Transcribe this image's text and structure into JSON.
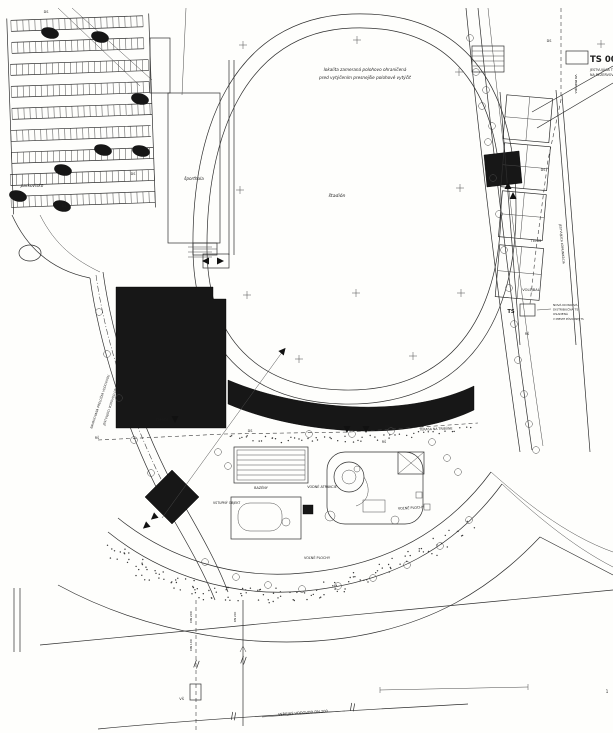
{
  "drawing": {
    "type": "site-plan",
    "language": "sk",
    "paper_color": "#fefefc",
    "ink_color": "#1c1c1c",
    "building_fill": "#171717"
  },
  "legend": {
    "ts_title": "TS 0062-",
    "ts_note1": "JESTVUJÚCA TS, NA",
    "ts_note2": "NA REZERVOVÝ VÝVOD"
  },
  "labels": [
    {
      "name": "survey-note-line1",
      "text": "lokalita zameraná polohovo ohraničená",
      "x": 365,
      "y": 71,
      "s": 4.2,
      "i": 1,
      "a": "middle"
    },
    {
      "name": "survey-note-line2",
      "text": "pred vytýčením presnejšie polohové vytýčiť",
      "x": 365,
      "y": 79,
      "s": 4.2,
      "i": 1,
      "a": "middle"
    },
    {
      "name": "stadium-label",
      "text": "štadión",
      "x": 337,
      "y": 197,
      "s": 4.6,
      "i": 1,
      "a": "middle"
    },
    {
      "name": "sporthall-label",
      "text": "športhala",
      "x": 194,
      "y": 180,
      "s": 4.2,
      "i": 1,
      "a": "middle"
    },
    {
      "name": "parking-label",
      "text": "parkovisko",
      "x": 32,
      "y": 187,
      "s": 4.2,
      "i": 1,
      "a": "middle"
    },
    {
      "name": "legend-ts-title",
      "text": "TS 0062-",
      "x": 590,
      "y": 62,
      "s": 8.5,
      "a": "start",
      "b": 1
    },
    {
      "name": "legend-ts-note1",
      "text": "JESTVUJÚCA TS, NA",
      "x": 590,
      "y": 71,
      "s": 3.3,
      "a": "start"
    },
    {
      "name": "legend-ts-note2",
      "text": "NA REZERVOVÝ VÝVOD",
      "x": 590,
      "y": 76,
      "s": 3.3,
      "a": "start"
    },
    {
      "name": "vn-line-label",
      "text": "VN PRÍPOJKA",
      "x": 575,
      "y": 84,
      "s": 3,
      "r": 90,
      "a": "middle"
    },
    {
      "name": "tennis-label",
      "text": "TENIS",
      "x": 536,
      "y": 242,
      "s": 3.6,
      "a": "middle"
    },
    {
      "name": "volleyball-label",
      "text": "VOLEJBAL",
      "x": 531,
      "y": 291,
      "s": 3.6,
      "a": "middle"
    },
    {
      "name": "ts-mid-label",
      "text": "TS",
      "x": 511,
      "y": 313,
      "s": 5.2,
      "a": "middle",
      "b": 1
    },
    {
      "name": "ts-mid-note1",
      "text": "NOVÁ KIOSKOVÁ",
      "x": 553,
      "y": 306,
      "s": 3,
      "a": "start"
    },
    {
      "name": "ts-mid-note2",
      "text": "DISTRIBUČNÁ TS",
      "x": 553,
      "y": 310.5,
      "s": 3,
      "a": "start"
    },
    {
      "name": "ts-mid-note3",
      "text": "OSADENÁ",
      "x": 553,
      "y": 315,
      "s": 3,
      "a": "start"
    },
    {
      "name": "ts-mid-note4",
      "text": "V MIESTE PÔVODNEJ TS",
      "x": 553,
      "y": 320,
      "s": 2.6,
      "a": "start"
    },
    {
      "name": "terrace-label",
      "text": "TERASA NA TRIBÚNE",
      "x": 436,
      "y": 430,
      "s": 3.2,
      "r": -2,
      "a": "middle"
    },
    {
      "name": "terrace2-label",
      "text": "TERASA",
      "x": 162,
      "y": 421,
      "s": 3.2,
      "a": "middle"
    },
    {
      "name": "pools-label",
      "text": "BAZÉNY",
      "x": 261,
      "y": 489,
      "s": 3.4,
      "a": "middle"
    },
    {
      "name": "water-attractions-label",
      "text": "VODNÉ ATRAKCIE",
      "x": 322,
      "y": 488,
      "s": 3.4,
      "a": "middle"
    },
    {
      "name": "open-areas-label-1",
      "text": "VOĽNÉ PLOCHY",
      "x": 411,
      "y": 509,
      "s": 3.4,
      "r": -3,
      "a": "middle"
    },
    {
      "name": "open-areas-label-2",
      "text": "VOĽNÉ PLOCHY",
      "x": 317,
      "y": 559,
      "s": 3.4,
      "a": "middle"
    },
    {
      "name": "entrance-object-label",
      "text": "VSTUPNÝ OBJEKT",
      "x": 213,
      "y": 504,
      "s": 3.2,
      "a": "start"
    },
    {
      "name": "public-watermain-label",
      "text": "VEREJNÝ VODOVOD DN 200",
      "x": 303,
      "y": 714,
      "s": 3.6,
      "r": -4,
      "a": "middle"
    },
    {
      "name": "dn100-label",
      "text": "DN 100",
      "x": 192,
      "y": 645,
      "s": 3,
      "r": -90,
      "a": "middle"
    },
    {
      "name": "dn200-label",
      "text": "DN 200",
      "x": 192,
      "y": 617,
      "s": 3,
      "r": -90,
      "a": "middle"
    },
    {
      "name": "dn200b-label",
      "text": "DN 200",
      "x": 236,
      "y": 617,
      "s": 2.8,
      "r": -90,
      "a": "middle"
    },
    {
      "name": "vs-shaft-label",
      "text": "VŠ",
      "x": 184,
      "y": 700,
      "s": 3.6,
      "a": "end"
    },
    {
      "name": "ds-label-1",
      "text": "DS",
      "x": 46,
      "y": 13,
      "s": 3.4,
      "a": "middle"
    },
    {
      "name": "ds-label-2",
      "text": "DS",
      "x": 64,
      "y": 207,
      "s": 3.4,
      "a": "middle"
    },
    {
      "name": "ds-label-3",
      "text": "DS",
      "x": 133,
      "y": 175,
      "s": 3.4,
      "a": "middle"
    },
    {
      "name": "ds-label-4",
      "text": "DS",
      "x": 250,
      "y": 432,
      "s": 3.4,
      "a": "middle"
    },
    {
      "name": "ds-label-5",
      "text": "DS",
      "x": 387,
      "y": 428,
      "s": 3.4,
      "a": "middle"
    },
    {
      "name": "ds-label-6",
      "text": "DS",
      "x": 549,
      "y": 42,
      "s": 3.4,
      "a": "middle"
    },
    {
      "name": "ds-label-7",
      "text": "DS",
      "x": 543,
      "y": 171,
      "s": 3.4,
      "a": "middle"
    },
    {
      "name": "rs-label-1",
      "text": "RŠ",
      "x": 384,
      "y": 443,
      "s": 3.2,
      "a": "middle"
    },
    {
      "name": "rs-label-2",
      "text": "RŠ",
      "x": 97,
      "y": 439,
      "s": 3.2,
      "a": "middle"
    },
    {
      "name": "rs-label-3",
      "text": "RŠ",
      "x": 527,
      "y": 335,
      "s": 3.2,
      "a": "middle"
    },
    {
      "name": "relocation-label-1",
      "text": "NAVRHOVANÁ PRELOŽKA VODOVODU",
      "x": 101,
      "y": 402,
      "s": 3,
      "r": -72,
      "a": "middle"
    },
    {
      "name": "relocation-label-2",
      "text": "JESTVUJÚCI VODOVOD DN 200",
      "x": 112,
      "y": 404,
      "s": 3,
      "r": -72,
      "a": "middle"
    },
    {
      "name": "road-label",
      "text": "JESTVUJÚCA KOMUNIKÁCIA",
      "x": 561,
      "y": 244,
      "s": 3,
      "r": 85,
      "a": "middle"
    },
    {
      "name": "sheet-number",
      "text": "1",
      "x": 607,
      "y": 693,
      "s": 4,
      "a": "middle"
    }
  ],
  "crosses": [
    [
      243,
      45
    ],
    [
      357,
      40
    ],
    [
      459,
      72
    ],
    [
      601,
      44
    ],
    [
      240,
      190
    ],
    [
      460,
      188
    ],
    [
      247,
      295
    ],
    [
      356,
      293
    ],
    [
      461,
      293
    ],
    [
      299,
      359
    ],
    [
      413,
      356
    ]
  ],
  "dark_blobs": [
    [
      50,
      33
    ],
    [
      100,
      37
    ],
    [
      63,
      170
    ],
    [
      18,
      196
    ],
    [
      62,
      206
    ],
    [
      140,
      99
    ],
    [
      103,
      150
    ],
    [
      141,
      151
    ]
  ],
  "trees": [
    [
      470,
      38
    ],
    [
      476,
      72
    ],
    [
      482,
      106
    ],
    [
      488,
      142
    ],
    [
      493,
      178
    ],
    [
      499,
      214
    ],
    [
      504,
      250
    ],
    [
      509,
      288
    ],
    [
      514,
      324
    ],
    [
      518,
      360
    ],
    [
      486,
      90
    ],
    [
      492,
      126
    ],
    [
      99,
      312
    ],
    [
      107,
      354
    ],
    [
      119,
      398
    ],
    [
      134,
      440
    ],
    [
      151,
      473
    ],
    [
      205,
      562
    ],
    [
      236,
      577
    ],
    [
      268,
      585
    ],
    [
      302,
      589
    ],
    [
      338,
      586
    ],
    [
      373,
      578
    ],
    [
      407,
      565
    ],
    [
      440,
      546
    ],
    [
      469,
      520
    ],
    [
      218,
      452
    ],
    [
      228,
      466
    ],
    [
      432,
      442
    ],
    [
      447,
      458
    ],
    [
      458,
      472
    ],
    [
      352,
      434
    ],
    [
      391,
      431
    ],
    [
      309,
      434
    ],
    [
      524,
      394
    ],
    [
      529,
      424
    ],
    [
      536,
      450
    ]
  ],
  "triangles": [
    [
      175,
      419,
      180
    ],
    [
      347,
      429,
      180
    ],
    [
      366,
      429,
      180
    ],
    [
      513,
      196,
      0
    ],
    [
      508,
      186,
      0
    ],
    [
      154,
      517,
      230
    ],
    [
      146,
      526,
      230
    ],
    [
      283,
      351,
      40
    ],
    [
      206,
      261,
      -90
    ],
    [
      220,
      261,
      90
    ]
  ],
  "double_ticks": [
    [
      196,
      664,
      20
    ],
    [
      243,
      660,
      20
    ],
    [
      233,
      716,
      10
    ],
    [
      352,
      707,
      10
    ]
  ],
  "parking_rows": [
    [
      14,
      18,
      132
    ],
    [
      14,
      40,
      132
    ],
    [
      12,
      62,
      138
    ],
    [
      12,
      84,
      138
    ],
    [
      12,
      106,
      140
    ],
    [
      10,
      128,
      140
    ],
    [
      10,
      150,
      142
    ],
    [
      8,
      172,
      144
    ],
    [
      8,
      194,
      144
    ]
  ],
  "stipple_bands": [
    {
      "a": [
        112,
        548
      ],
      "b": [
        190,
        612
      ],
      "c": [
        330,
        620
      ],
      "d": [
        470,
        524
      ],
      "n": 140,
      "w": 16
    },
    {
      "a": [
        230,
        436
      ],
      "b": [
        300,
        444
      ],
      "c": [
        380,
        440
      ],
      "d": [
        470,
        428
      ],
      "n": 55,
      "w": 6
    }
  ]
}
